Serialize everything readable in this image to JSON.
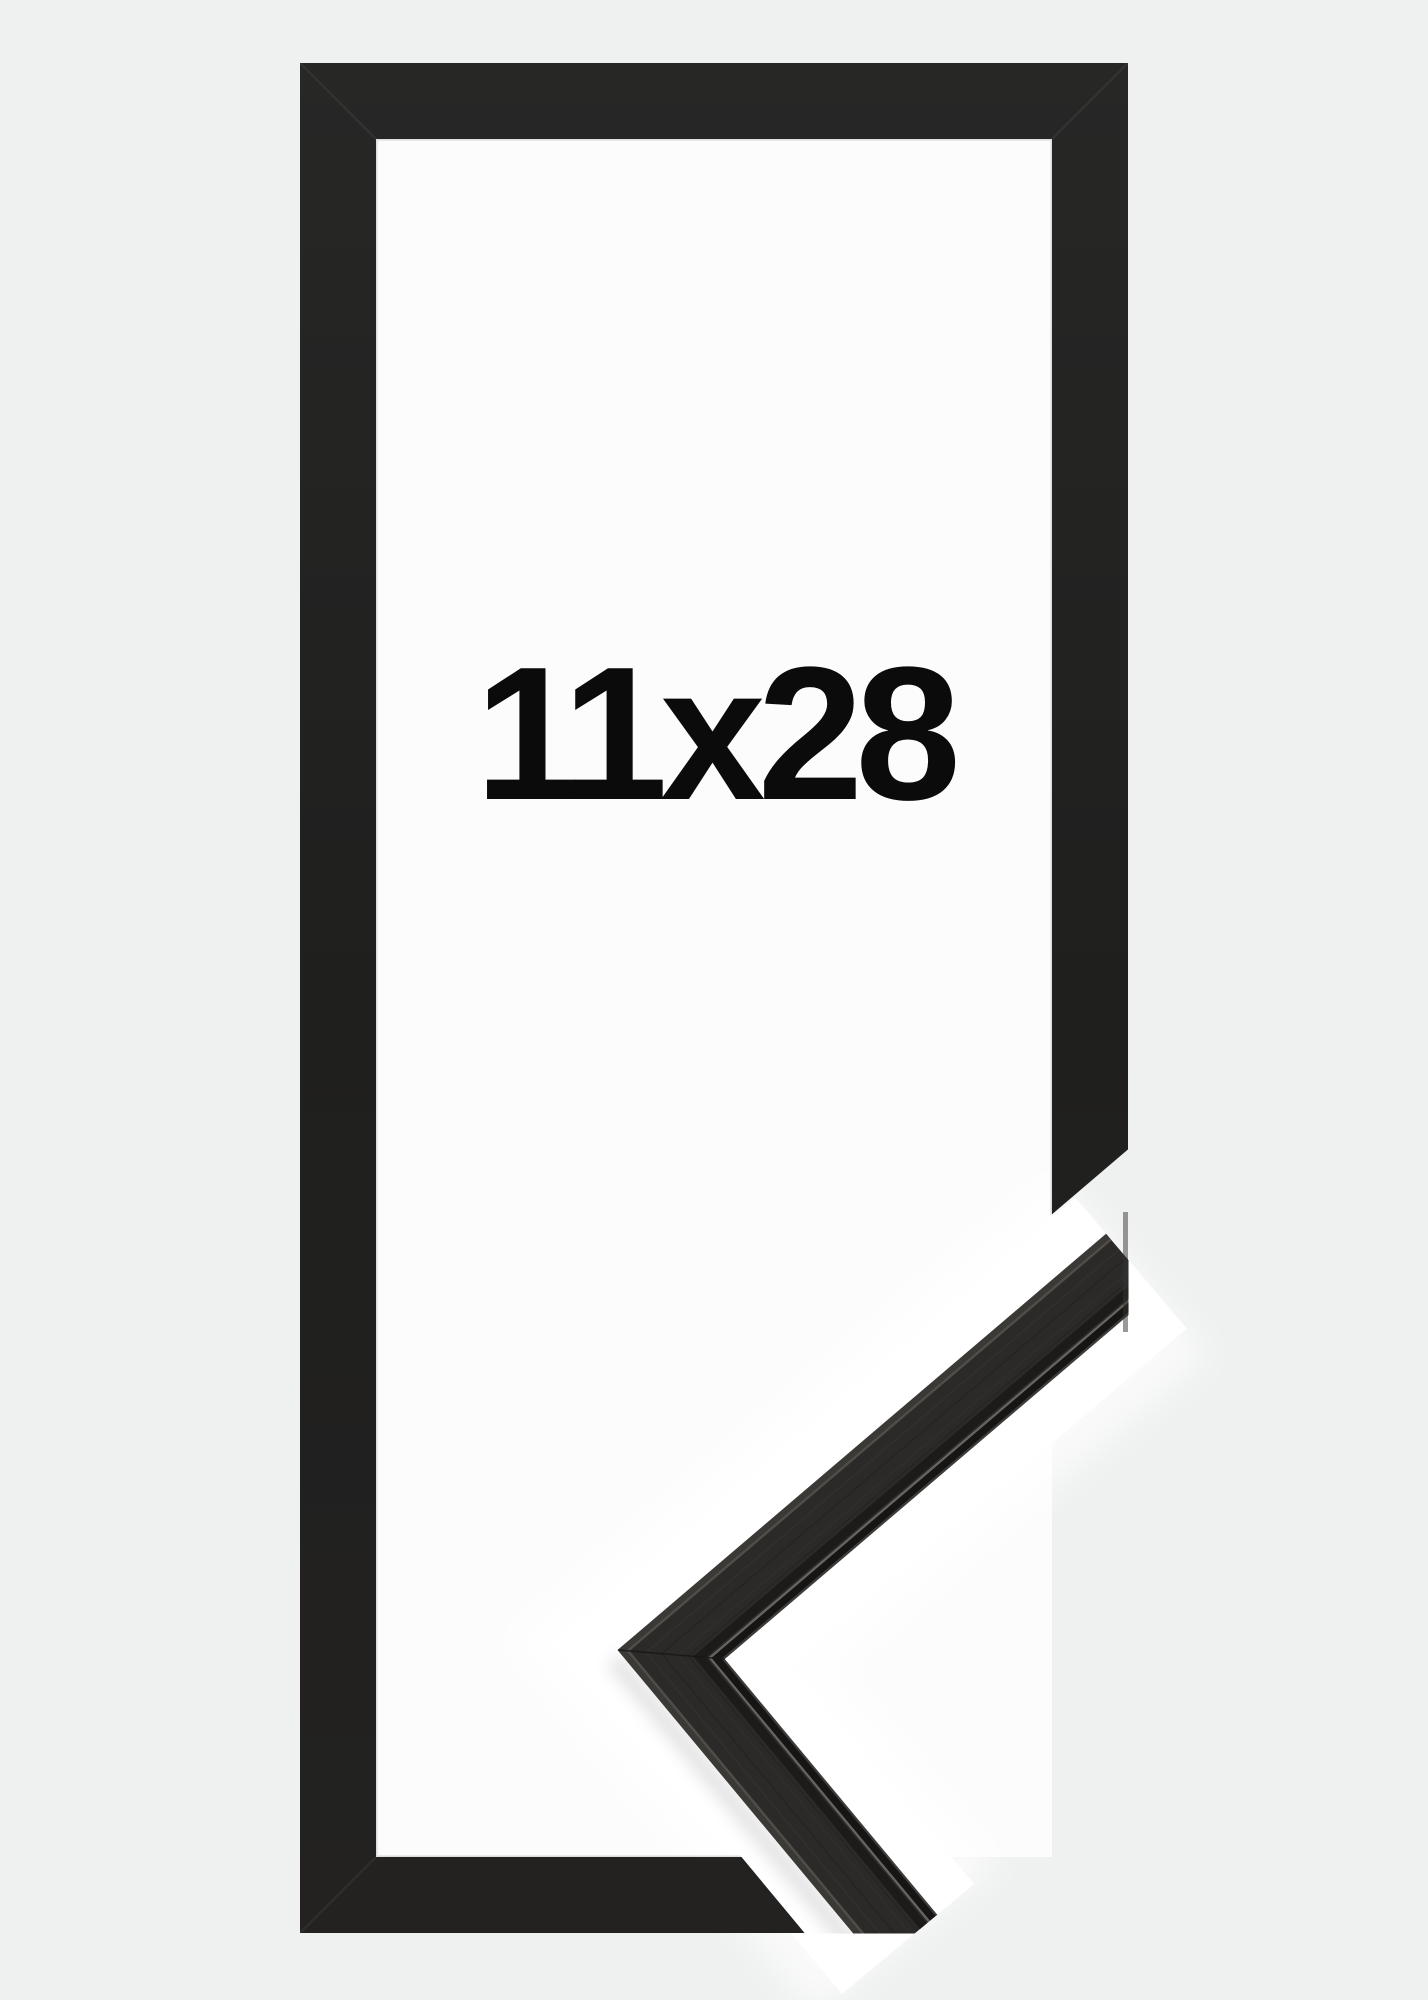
{
  "product_image": {
    "size_label": "11x28",
    "colors": {
      "background": "#eff0f0",
      "frame_bar": "#212120",
      "frame_window": "#fcfcfc",
      "cut_gap": "#ffffff",
      "label_text": "#0b0b0b",
      "corner_sample_face": "#2b2a29",
      "corner_sample_groove": "#1c1b1a",
      "corner_sample_lip_highlight": "#6e6a65"
    }
  }
}
